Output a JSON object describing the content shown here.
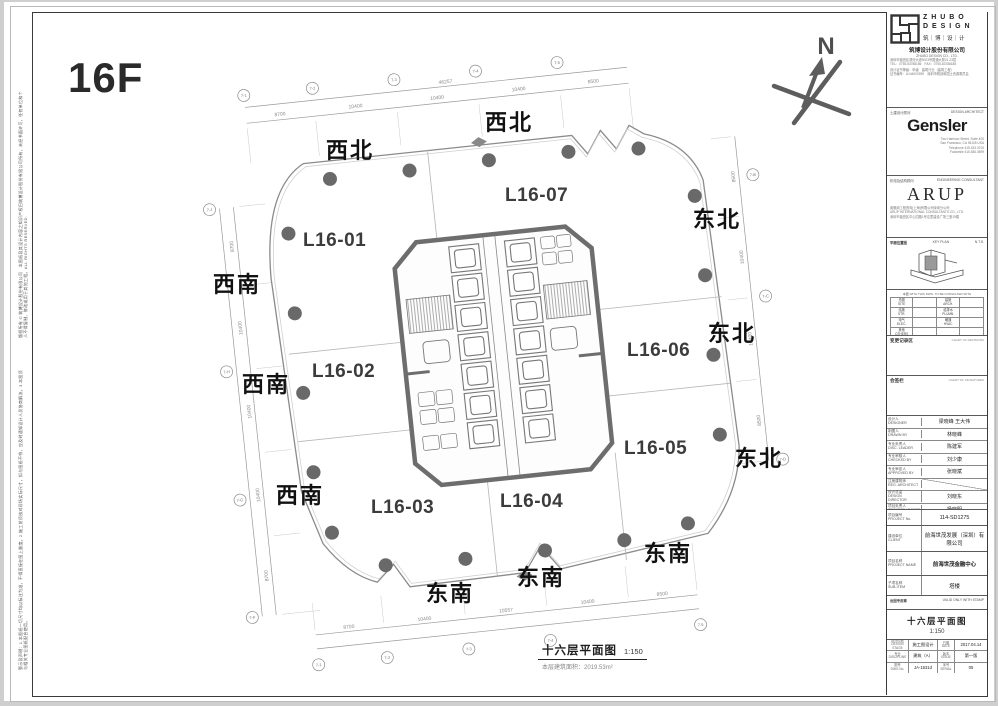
{
  "page": {
    "floor_label": "16F",
    "north_label": "N",
    "margin_text_top": "版权所有 © 筑博设计股份有限公司　本图纸及其设计内容之知识产权归筑博设计股份有限公司所有，未经书面许可，任何单位和个人不得复制、修改或用于其他工程。ALL RIGHTS RESERVED.",
    "margin_text_bottom": "警示及声明：1.本图纸一切尺寸均以标注为准，不得直接在图上量度。2.施工前须核对现场实际尺寸，如与图纸不符，应及时通知设计人员协商解决。3.本图须与相关专业图纸配合使用。"
  },
  "plan": {
    "units": [
      {
        "label": "L16-01"
      },
      {
        "label": "L16-02"
      },
      {
        "label": "L16-03"
      },
      {
        "label": "L16-04"
      },
      {
        "label": "L16-05"
      },
      {
        "label": "L16-06"
      },
      {
        "label": "L16-07"
      }
    ],
    "directions": [
      {
        "label": "西北"
      },
      {
        "label": "西北"
      },
      {
        "label": "东北"
      },
      {
        "label": "东北"
      },
      {
        "label": "东北"
      },
      {
        "label": "西南"
      },
      {
        "label": "西南"
      },
      {
        "label": "西南"
      },
      {
        "label": "东南"
      },
      {
        "label": "东南"
      },
      {
        "label": "东南"
      }
    ],
    "caption": {
      "title": "十六层平面图",
      "scale": "1:150",
      "area_label": "本层建筑面积：",
      "area_value": "2019.53m²"
    },
    "grid": {
      "top_bubbles": [
        "7-1",
        "7-2",
        "7-3",
        "7-4",
        "7-5"
      ],
      "top_dims": [
        "8700",
        "10400",
        "10400",
        "10400",
        "8500"
      ],
      "top_total": "46257",
      "bottom_bubbles": [
        "7-1",
        "7-2",
        "7-3",
        "7-4",
        "7-5"
      ],
      "bottom_dims": [
        "8700",
        "10400",
        "10557",
        "10400",
        "8500"
      ],
      "left_bubbles": [
        "7-J",
        "7-H",
        "7-G",
        "7-F"
      ],
      "left_dims": [
        "8700",
        "10400",
        "10400",
        "10400",
        "8700"
      ],
      "right_bubbles": [
        "7-B",
        "7-C",
        "7-D"
      ],
      "right_dims": [
        "8500",
        "10400",
        "10400",
        "8500"
      ]
    }
  },
  "titleblock": {
    "zhubo": {
      "name_line1": "Z H U B O",
      "name_line2": "D E S I G N",
      "name_cn": "筑｜博｜设｜计",
      "company_cn": "筑博设计股份有限公司",
      "company_en": "ZHUBO DESIGN CO., LTD.",
      "address": "深圳市福田区滨河大道9023号国通大厦21-23层\nTEL：0755-83788186　FAX：0755-83788188",
      "cert": "设计证书等级：甲级　建筑行业（建筑工程）\n证书编号：A144003939　深圳市规划和国土资源委员会"
    },
    "gensler": {
      "role_cn": "土建设计顾问",
      "role_en": "DESIGN ARCHITECT",
      "logo": "Gensler",
      "address": "Two Harrison Street, Suite 400\nSan Francisco, CA 94105 USA\nTelephone 415.433.3700\nFacsimile 415.836.4599"
    },
    "arup": {
      "role_cn": "机电及结构顾问",
      "role_en": "ENGINEERING CONSULTANT",
      "logo": "ARUP",
      "address": "奥雅纳工程咨询(上海)有限公司深圳分公司\nARUP INTERNATIONAL CONSULTANTS CO., LTD.\n深圳市福田区中心四路1号嘉里建设广场三座15楼"
    },
    "keyplan": {
      "label_cn": "平面位置图",
      "label_en": "KEY PLAN",
      "nts": "N.T.S."
    },
    "refs": {
      "header": "本图 WITH THIS DWG. TO BE CONSULTED WITH",
      "rows": [
        [
          "总图\nSITE",
          "建施\nARCH."
        ],
        [
          "结施\nSTR.",
          "给排水\nPLUMB."
        ],
        [
          "电气\nELEC.",
          "暖通\nHVAC"
        ],
        [
          "其他\nOTHERS",
          ""
        ]
      ]
    },
    "sections": {
      "rev_cn": "变更记录区",
      "rev_en": "CHART OF REVISIONS",
      "sign_cn": "会签栏",
      "sign_en": "CHART OF SIGNATURES"
    },
    "personnel": [
      {
        "label": "设计人\nDESIGNER",
        "value": "梁晓峰  王大伟"
      },
      {
        "label": "制图人\nDRAWN BY",
        "value": "林晓峰"
      },
      {
        "label": "专业负责人\nDISC. LEADER",
        "value": "陈建军"
      },
      {
        "label": "专业审核人\nCHECKED BY",
        "value": "刘少康"
      },
      {
        "label": "专业审定人\nAPPROVED BY",
        "value": "张晓斌"
      },
      {
        "label": "注册建筑师\nREG. ARCHITECT",
        "value": ""
      },
      {
        "label": "设计总监\nDESIGN DIRECTOR",
        "value": "刘晓东"
      },
      {
        "label": "项目负责人\nPROJECT LEADER",
        "value": "杨晓明"
      }
    ],
    "project": {
      "no_label": "项目编号\nPROJECT No.",
      "no": "114-SD1275",
      "client_label": "建设单位\nCLIENT",
      "client": "前海世茂发展（深圳）有限公司",
      "name_label": "项目名称\nPROJECT NAME",
      "name": "前海世茂金融中心",
      "sub_label": "子项名称\nSUB-ITEM",
      "sub": "塔楼",
      "stamp_label": "出图专用章",
      "stamp_note": "VALID ONLY WITH STAMP"
    },
    "sheet": {
      "title": "十六层平面图",
      "scale": "1:150"
    },
    "bottom": {
      "r1": [
        "设计阶段\nDESIGN STAGE",
        "施工图设计",
        "日期\nDATE",
        "2017.04.14"
      ],
      "r2": [
        "专业\nDISCIPLINE",
        "建筑（A）",
        "版本\nISSUE",
        "第一版"
      ],
      "r3": [
        "图号\nDWG No.",
        "JA-1631d",
        "序号\nSERIAL",
        "05"
      ]
    }
  }
}
